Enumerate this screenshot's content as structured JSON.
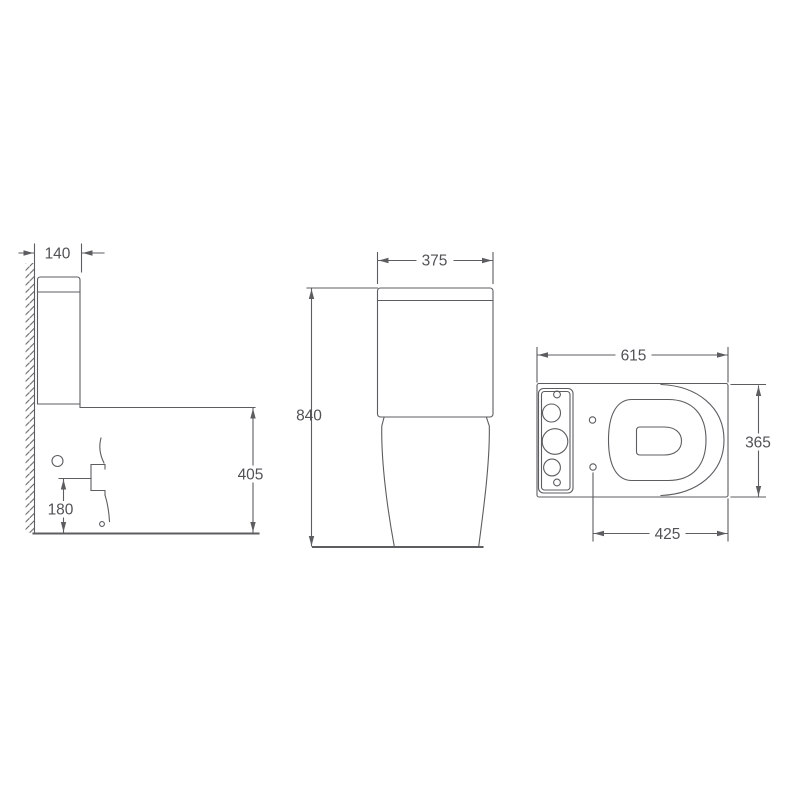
{
  "drawing": {
    "colors": {
      "line": "#5c5d60",
      "text": "#515256",
      "paper": "#ffffff"
    },
    "views": {
      "side": {
        "dims": {
          "tank_depth": "140",
          "bowl_height": "405",
          "outlet_height": "180"
        }
      },
      "front": {
        "dims": {
          "tank_width": "375",
          "total_height": "840"
        }
      },
      "plan": {
        "dims": {
          "total_length": "615",
          "bowl_width": "365",
          "seat_hole_to_front": "425"
        }
      }
    }
  }
}
